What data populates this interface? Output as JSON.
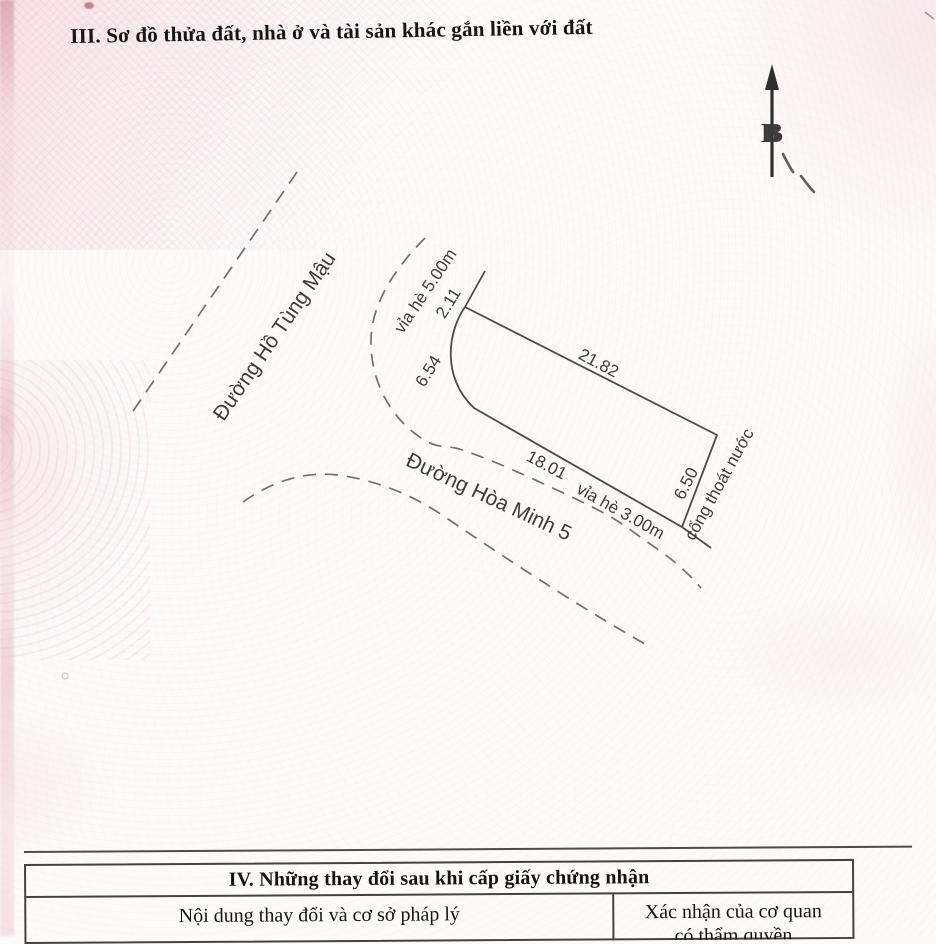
{
  "page": {
    "section3_title": "III. Sơ đồ thửa đất, nhà ở và tài sản khác gắn liền với đất",
    "section4": {
      "title": "IV. Những thay đổi sau khi cấp giấy chứng nhận",
      "col_left_header": "Nội dung thay đổi và cơ sở pháp lý",
      "col_right_header_line1": "Xác nhận của cơ quan",
      "col_right_header_line2": "có thẩm quyền"
    }
  },
  "diagram": {
    "north_label": "B",
    "roads": {
      "road1": "Đường Hồ Tùng Mậu",
      "road2": "Đường Hòa Minh 5"
    },
    "sidewalks": {
      "sidewalk1": "vỉa hè 5.00m",
      "sidewalk2": "vỉa hè 3.00m"
    },
    "drainage": "cống thoát nước",
    "dimensions": {
      "chamfer": "2.11",
      "arc": "6.54",
      "northeast": "21.82",
      "southwest": "18.01",
      "southeast": "6.50"
    }
  },
  "colors": {
    "paper": "#fdfbfa",
    "watermark_pink": "#eec3cb",
    "line": "#4a4a4a",
    "text": "#161616"
  }
}
